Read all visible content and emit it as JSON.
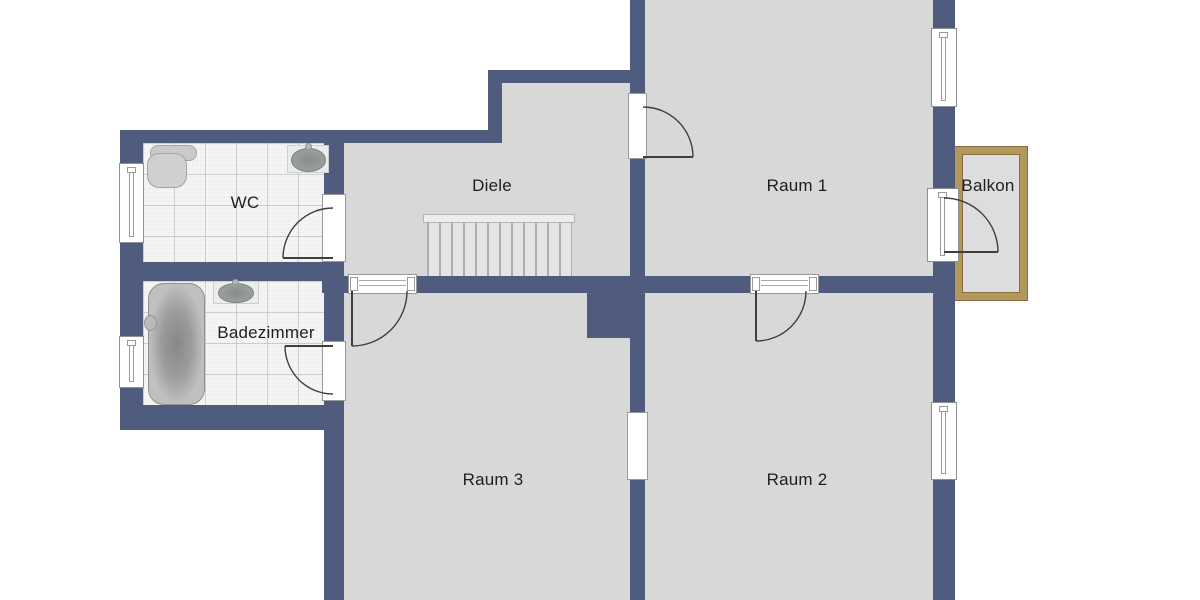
{
  "plan": {
    "type": "floor-plan",
    "rooms": {
      "wc": {
        "label": "WC"
      },
      "badezimmer": {
        "label": "Badezimmer"
      },
      "diele": {
        "label": "Diele"
      },
      "raum1": {
        "label": "Raum 1"
      },
      "raum2": {
        "label": "Raum 2"
      },
      "raum3": {
        "label": "Raum 3"
      },
      "balkon": {
        "label": "Balkon"
      }
    },
    "fixtures": [
      {
        "name": "toilet",
        "room": "wc"
      },
      {
        "name": "sink",
        "room": "wc"
      },
      {
        "name": "sink",
        "room": "badezimmer"
      },
      {
        "name": "bathtub",
        "room": "badezimmer"
      },
      {
        "name": "stairs",
        "room": "diele"
      }
    ],
    "doors": [
      {
        "from": "diele",
        "to": "wc"
      },
      {
        "from": "raum3",
        "to": "badezimmer"
      },
      {
        "from": "diele",
        "to": "raum1"
      },
      {
        "from": "diele",
        "to": "raum3"
      },
      {
        "from": "diele",
        "to": "raum2"
      },
      {
        "from": "raum1",
        "to": "balkon"
      },
      {
        "from": "raum3",
        "to": "raum2"
      }
    ],
    "colors": {
      "wall": "#505c7d",
      "floor": "#d8d8d8",
      "tile": "#f4f4f2",
      "balcony_border": "#b3985e",
      "balcony_floor": "#dcdddf",
      "outside": "#ffffff",
      "label_text": "#1e1e1e"
    }
  }
}
